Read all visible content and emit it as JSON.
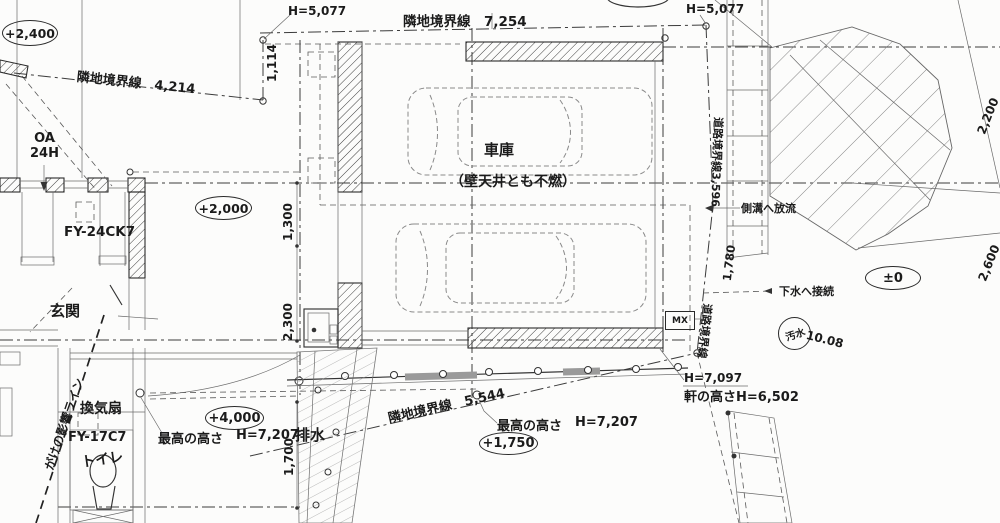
{
  "drawing": {
    "levels": {
      "l2400": "+2,400",
      "l2000": "+2,000",
      "l4000": "+4,000",
      "l1750": "+1,750",
      "l0": "±0"
    },
    "boundaries": {
      "nw": "隣地境界線　4,214",
      "top": "隣地境界線　7,254",
      "road_upper": "道路境界線3,596",
      "road_lower": "道路境界線",
      "sw": "隣地境界線　5,544"
    },
    "heights": {
      "h5077_left": "H=5,077",
      "h5077_right": "H=5,077",
      "max_left_label": "最高の高さ",
      "max_left_value": "H=7,207",
      "max_right_label": "最高の高さ",
      "max_right_value": "H=7,207",
      "h7097": "H=7,097",
      "eave": "軒の高さH=6,502"
    },
    "dims": {
      "d1114": "1,114",
      "d1300": "1,300",
      "d2300": "2,300",
      "d1700": "1,700",
      "d1780": "1,780",
      "d2200": "2,200",
      "d2600": "2,600"
    },
    "rooms": {
      "garage": "車庫",
      "garage_note": "（壁天井とも不燃）",
      "entrance": "玄関",
      "toilet": "トイレ"
    },
    "equipment": {
      "oa": "OA",
      "h24": "24H",
      "fan_upper": "FY-24CK7",
      "fan_label": "換気扇",
      "fan_lower": "FY-17C7",
      "mx": "MX"
    },
    "notes": {
      "gutter": "側溝へ放流",
      "sewer": "下水へ接続",
      "sewage": "汚水",
      "sewage_value": "10.08",
      "drain": "排水",
      "cliff": "がけの影響ライン"
    }
  }
}
